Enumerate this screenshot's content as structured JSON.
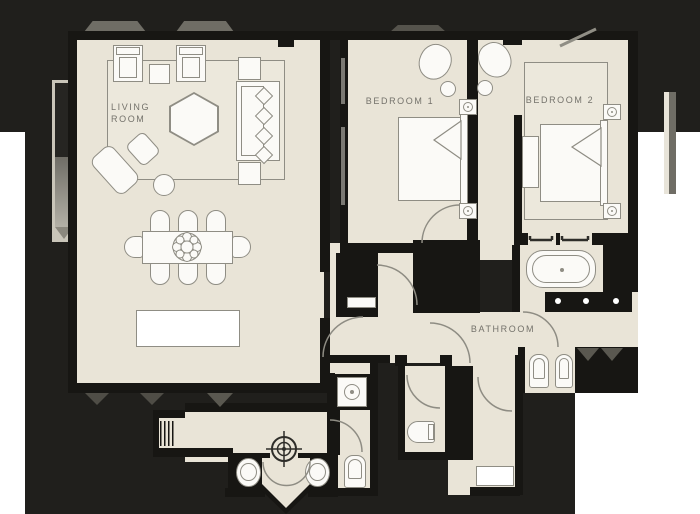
{
  "title": "apartment-floorplan",
  "colors": {
    "canvas": "#ffffff",
    "background_blob": "#201f1c",
    "wall": "#171613",
    "floor": "#e9e4d7",
    "rug": "#ece8dc",
    "furniture_fill": "#fbfaf7",
    "furniture_stroke": "#8f8d84",
    "label_text": "#74726b",
    "shadow_gray": "#6f6d65"
  },
  "rooms": {
    "living_room": {
      "label": "LIVING ROOM"
    },
    "bedroom_1": {
      "label": "BEDROOM 1"
    },
    "bedroom_2": {
      "label": "BEDROOM 2"
    },
    "bathroom": {
      "label": "BATHROOM"
    }
  },
  "fixtures": [
    "sofa",
    "armchair",
    "hexagon-coffee-table",
    "chaise-longue",
    "ottoman",
    "dining-table",
    "dining-chair",
    "console-table",
    "double-bed",
    "nightstand-lamp",
    "bed-bench",
    "area-rug",
    "bathtub",
    "towel-rail",
    "vanity-sinks",
    "toilet",
    "bidet",
    "washing-machine",
    "washbasin",
    "wardrobe",
    "compass-rose",
    "door-swing",
    "window-bay"
  ]
}
